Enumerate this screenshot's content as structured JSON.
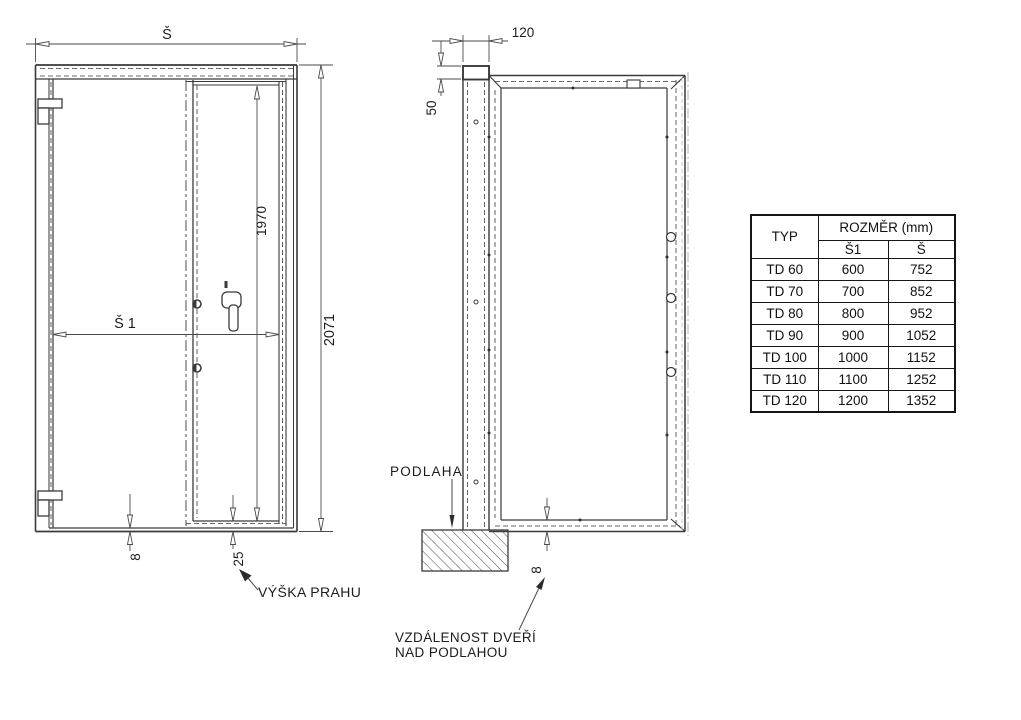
{
  "front_view": {
    "width_label": "Š",
    "clear_width_label": "Š 1",
    "leaf_height": "1970",
    "total_height": "2071",
    "bottom_gap": "8",
    "threshold_height": "25",
    "threshold_note": "VÝŠKA PRAHU"
  },
  "side_view": {
    "frame_depth": "120",
    "top_offset": "50",
    "floor_label": "PODLAHA",
    "floor_gap": "8",
    "gap_note_line1": "VZDÁLENOST DVEŘÍ",
    "gap_note_line2": "NAD PODLAHOU"
  },
  "size_table": {
    "col_type": "TYP",
    "col_dimension": "ROZMĚR (mm)",
    "col_width1": "Š1",
    "col_width": "Š",
    "rows": [
      {
        "type": "TD 60",
        "s1": "600",
        "s": "752"
      },
      {
        "type": "TD 70",
        "s1": "700",
        "s": "852"
      },
      {
        "type": "TD 80",
        "s1": "800",
        "s": "952"
      },
      {
        "type": "TD 90",
        "s1": "900",
        "s": "1052"
      },
      {
        "type": "TD 100",
        "s1": "1000",
        "s": "1152"
      },
      {
        "type": "TD 110",
        "s1": "1100",
        "s": "1252"
      },
      {
        "type": "TD 120",
        "s1": "1200",
        "s": "1352"
      }
    ]
  }
}
